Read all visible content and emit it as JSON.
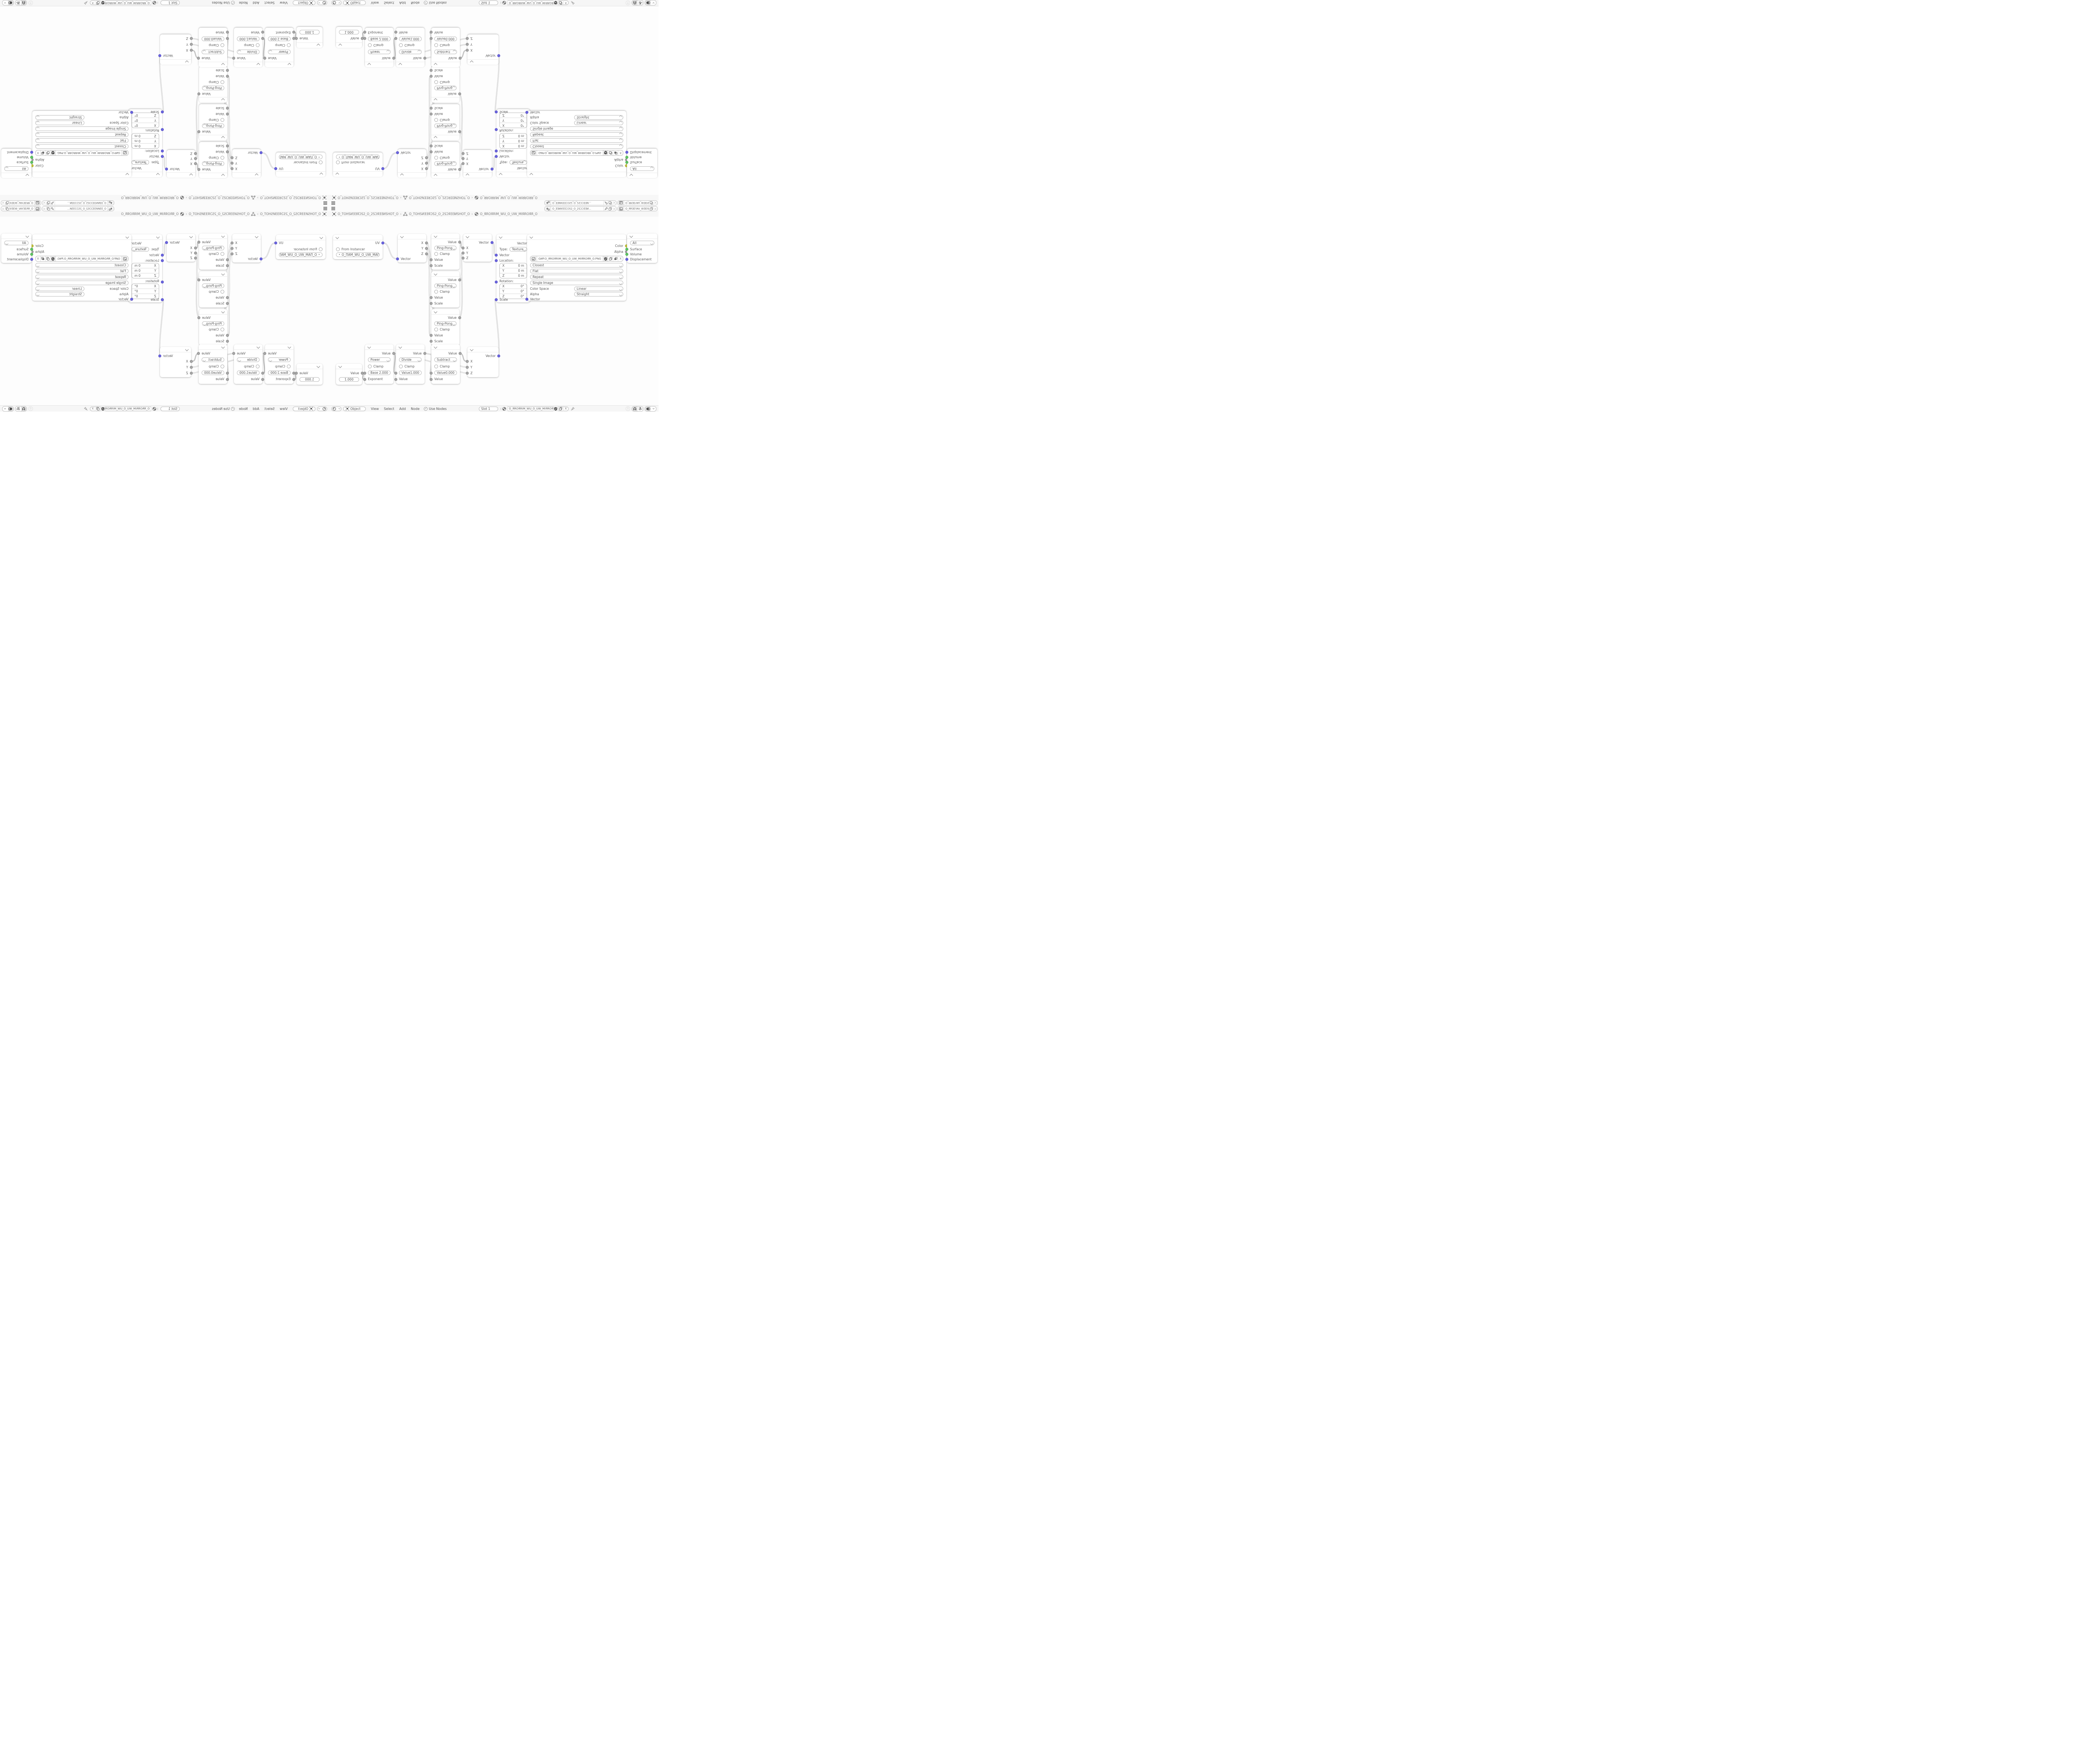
{
  "q": {
    "strip": {
      "scene_icon": "scene-icon",
      "scene_name": "O_ƎƎИИƎƎƆƆS2_O_2SƆƆƎƎИ...",
      "layer_icon": "image-icon",
      "layer_name": "O_ЯRƎEYAV_WƎEIW_O_WIƎEW_VAYƎER_O"
    },
    "breadcrumb": {
      "object": "O_TOHSИƎƎЯƆS2_O_2SƆЯƎƎИSHOT_O",
      "mesh": "O_TOHSИƎƎЯƆS2_O_2SƆЯƎƎИSHOT_O",
      "material": "O_ЯROЯRIM_WU_O_UW_MIЯROЯR_O",
      "sep": "›"
    },
    "nodes": {
      "uvmap": {
        "output": "UV",
        "checkbox": "From Instancer",
        "map_name": "O_ПAM_WU_O_UW_MAП_O",
        "close": "X"
      },
      "separate": {
        "outputs": {
          "x": "X",
          "y": "Y",
          "z": "Z"
        },
        "input": "Vector"
      },
      "pingpong": {
        "output": "Value",
        "operation": "Ping-Pong",
        "clamp": "Clamp",
        "in_value": "Value",
        "in_scale": "Scale"
      },
      "value": {
        "output": "Value",
        "value": "1.000"
      },
      "power": {
        "output": "Value",
        "operation": "Power",
        "clamp": "Clamp",
        "field_label": "Base",
        "field_value": "2.000",
        "input": "Exponent"
      },
      "divide": {
        "output": "Value",
        "operation": "Divide",
        "clamp": "Clamp",
        "field_label": "Value",
        "field_value": "1.000",
        "input": "Value"
      },
      "subtract": {
        "output": "Value",
        "operation": "Subtract",
        "clamp": "Clamp",
        "field_label": "Value",
        "field_value": "0.000",
        "input": "Value"
      },
      "combine": {
        "output": "Vector",
        "inputs": {
          "x": "X",
          "y": "Y",
          "z": "Z"
        }
      },
      "mapping": {
        "output": "Vector",
        "type_label": "Type:",
        "type_value": "Texture",
        "input": "Vector",
        "loc_label": "Location:",
        "loc": [
          {
            "axis": "X",
            "val": "0 m"
          },
          {
            "axis": "Y",
            "val": "0 m"
          },
          {
            "axis": "Z",
            "val": "0 m"
          }
        ],
        "rot_label": "Rotation:",
        "rot": [
          {
            "axis": "X",
            "val": "0°"
          },
          {
            "axis": "Y",
            "val": "0°"
          },
          {
            "axis": "Z",
            "val": "0°"
          }
        ],
        "scale_label": "Scale"
      },
      "image": {
        "out_color": "Color",
        "out_alpha": "Alpha",
        "file_name": "GИP.O_ЯROЯRIM_WU_O_UW_MIЯROЯR_O.PNG",
        "interpolation": "Closest",
        "projection": "Flat",
        "extension": "Repeat",
        "source": "Single Image",
        "cs_label": "Color Space",
        "cs_value": "Linear",
        "alpha_label": "Alpha",
        "alpha_value": "Straight",
        "input": "Vector",
        "close": "X"
      },
      "output": {
        "target": "All",
        "in_surface": "Surface",
        "in_volume": "Volume",
        "in_displacement": "Displacement"
      }
    },
    "header": {
      "mode": "Object",
      "menu_view": "View",
      "menu_select": "Select",
      "menu_add": "Add",
      "menu_node": "Node",
      "use_nodes": "Use Nodes",
      "use_nodes_check": "✓",
      "slot": "Slot 1",
      "image_name": "O_ЯROЯRIM_WU_O_UW_MIЯROЯR_O",
      "close": "X"
    }
  },
  "colors": {
    "socket_value": "#a8a8a8",
    "socket_vector": "#6a64e0",
    "socket_color": "#c9c93c",
    "socket_shader": "#5fc763",
    "wire": "#c2c2c2",
    "node_bg": "#ffffff",
    "canvas_bg": "#fdfdfd",
    "header_bg": "#f6f6f6"
  }
}
